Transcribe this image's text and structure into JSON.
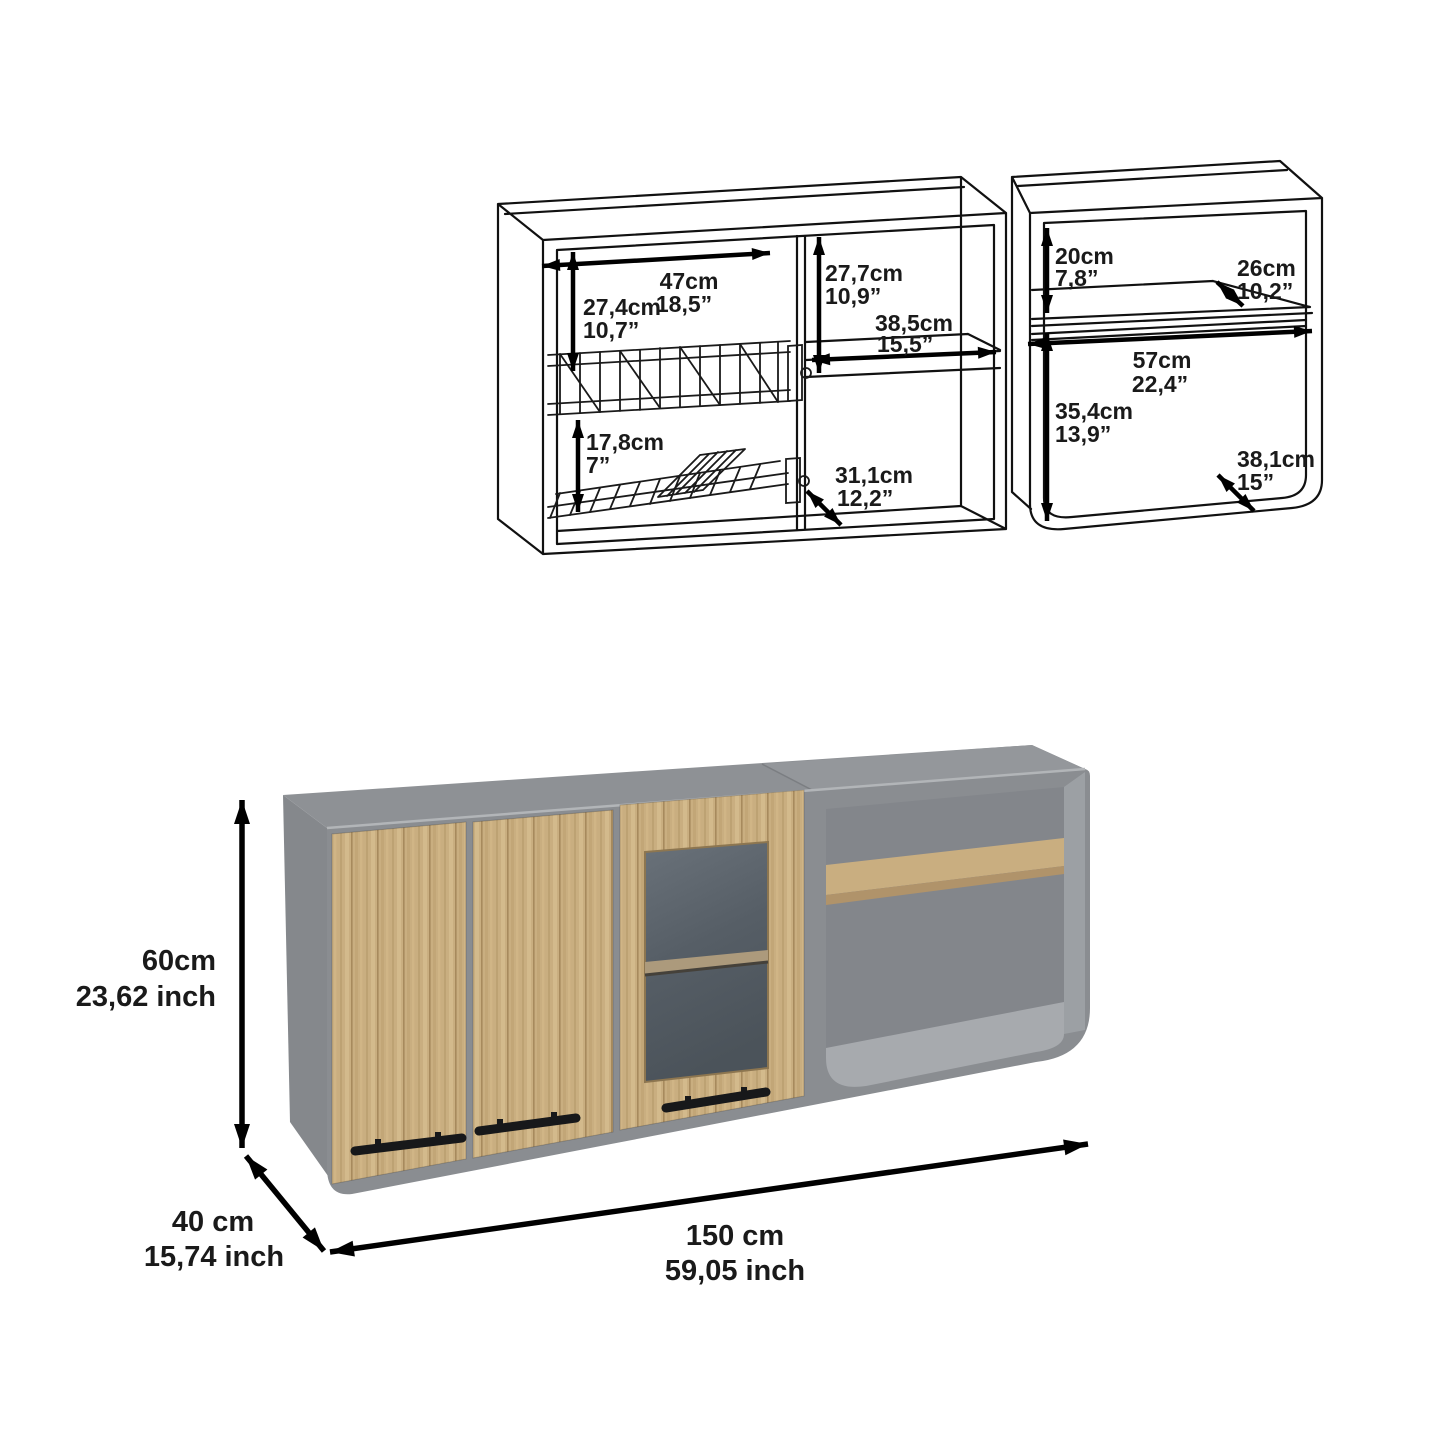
{
  "title": "Wall cabinet dimension sheet",
  "diagram": {
    "left_cabinet": {
      "interior_width_cm": "47cm",
      "interior_width_in": "18,5”",
      "upper_height_cm": "27,4cm",
      "upper_height_in": "10,7”",
      "rack_spacing_cm": "17,8cm",
      "rack_spacing_in": "7”",
      "mid_height_cm": "27,7cm",
      "mid_height_in": "10,9”",
      "mid_width_cm": "38,5cm",
      "mid_width_in": "15,5”",
      "mid_depth_cm": "31,1cm",
      "mid_depth_in": "12,2”"
    },
    "right_cabinet": {
      "top_height_cm": "20cm",
      "top_height_in": "7,8”",
      "shelf_depth_cm": "26cm",
      "shelf_depth_in": "10,2”",
      "interior_width_cm": "57cm",
      "interior_width_in": "22,4”",
      "lower_height_cm": "35,4cm",
      "lower_height_in": "13,9”",
      "interior_depth_cm": "38,1cm",
      "interior_depth_in": "15”"
    }
  },
  "render": {
    "height_cm": "60cm",
    "height_in": "23,62 inch",
    "depth_cm": "40 cm",
    "depth_in": "15,74 inch",
    "width_cm": "150 cm",
    "width_in": "59,05 inch"
  },
  "colors": {
    "wood": "#c9ae80",
    "wood_dark": "#b0936a",
    "carcass_gray": "#8a8d91",
    "glass": "#545c63",
    "handle": "#17181a",
    "line": "#111111"
  }
}
